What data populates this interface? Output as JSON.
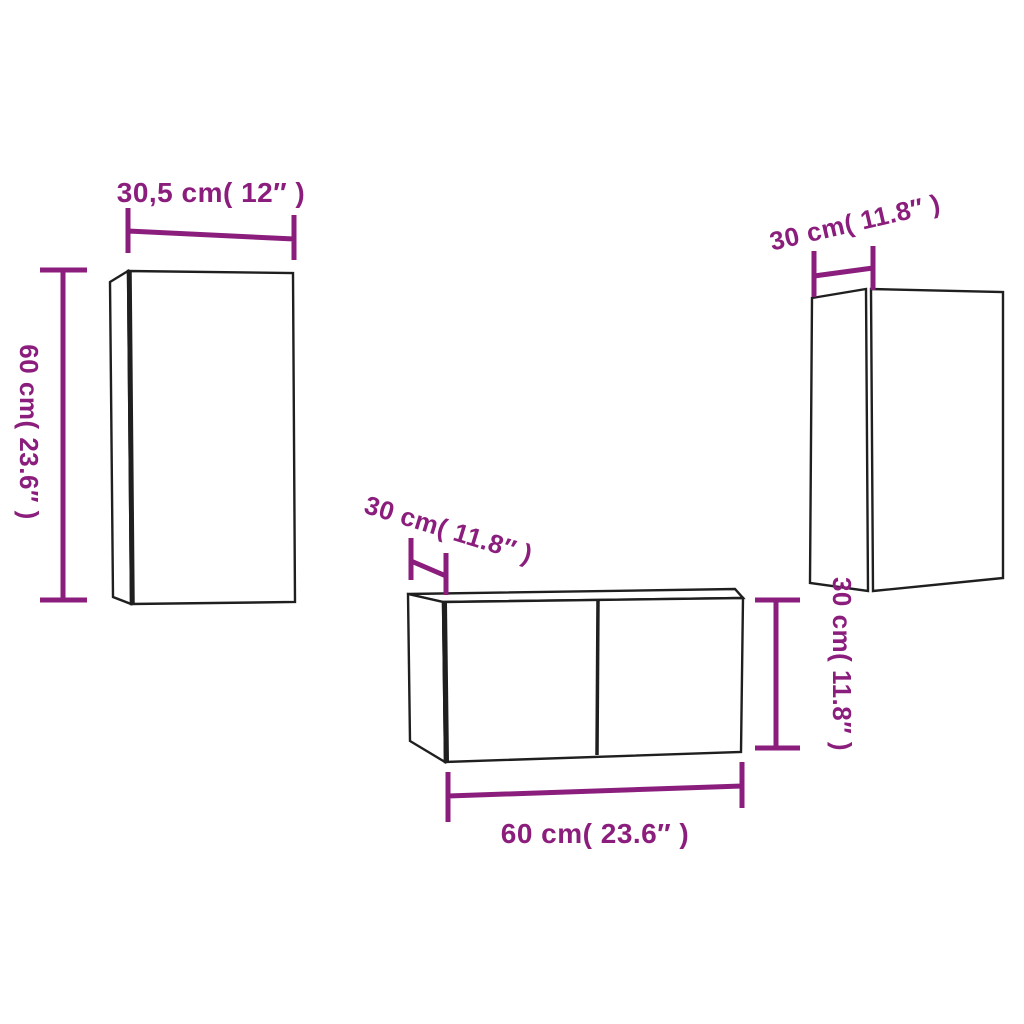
{
  "diagram": {
    "type": "furniture-dimension-diagram",
    "subject": "3-piece wall-mounted TV cabinet set",
    "units": [
      "cm",
      "inches"
    ]
  },
  "colors": {
    "dimension_accent": "#8b1e7d",
    "cabinet_outline": "#1f1f1f",
    "background": "#ffffff"
  },
  "labels": {
    "left_cabinet": {
      "width": "30,5 cm( 12″  )",
      "height": "60 cm( 23.6″  )"
    },
    "right_cabinet": {
      "depth": "30 cm( 11.8″  )"
    },
    "center_cabinet": {
      "depth": "30 cm( 11.8″  )",
      "width": "60 cm( 23.6″  )",
      "height": "30 cm( 11.8″  )"
    }
  }
}
